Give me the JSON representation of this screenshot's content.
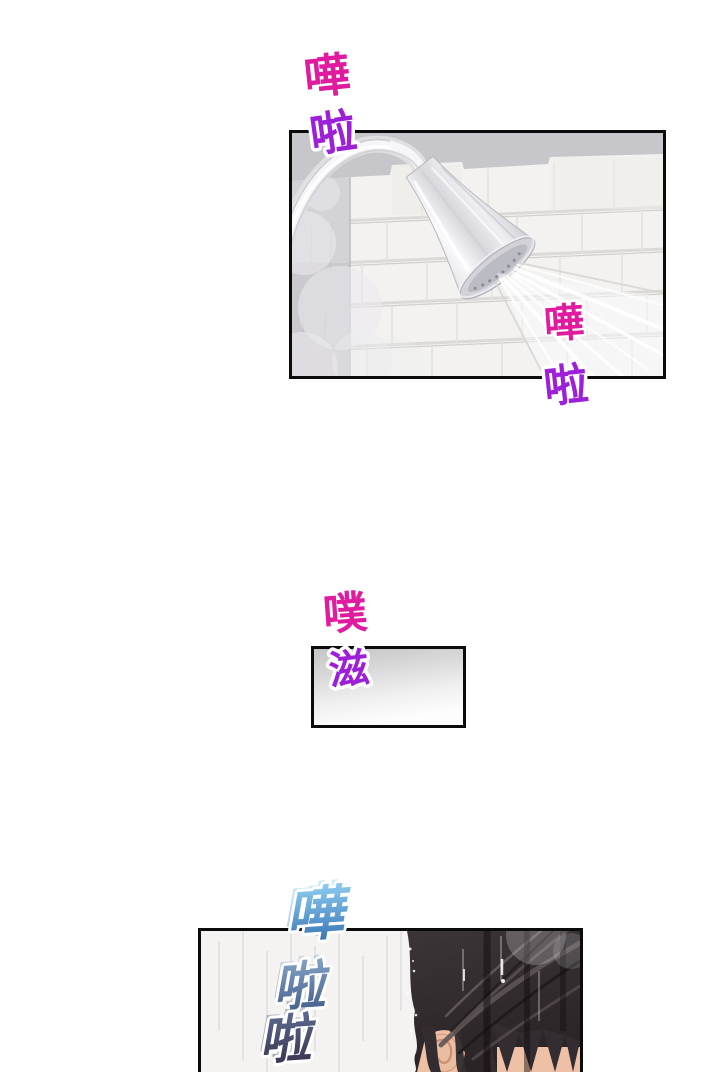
{
  "page": {
    "type": "comic-page",
    "background": "#ffffff"
  },
  "sfx": {
    "shower_top": {
      "a": "嘩",
      "b": "啦"
    },
    "shower_bottom": {
      "a": "嘩",
      "b": "啦"
    },
    "squish": {
      "a": "噗",
      "b": "滋"
    },
    "splash_bottom": {
      "a": "嘩",
      "b": "啦",
      "c": "啦"
    }
  },
  "colors": {
    "sfx_magenta": "#e01b9f",
    "sfx_purple": "#9d1fd8",
    "sfx_outline": "#ffffff",
    "sfx_blue_light": "#93d2f4",
    "sfx_blue_deep": "#2e6cb0",
    "sfx_steel_light": "#86a3c9",
    "sfx_steel_deep": "#3e5a84",
    "sfx_dark_light": "#5e6b93",
    "sfx_dark_deep": "#352f47",
    "panel_border": "#0b0b0b",
    "panel_gray_band": "#c7c6ca",
    "wall_white": "#f3f2f0",
    "hair": "#332d31",
    "skin": "#eec1a6"
  }
}
